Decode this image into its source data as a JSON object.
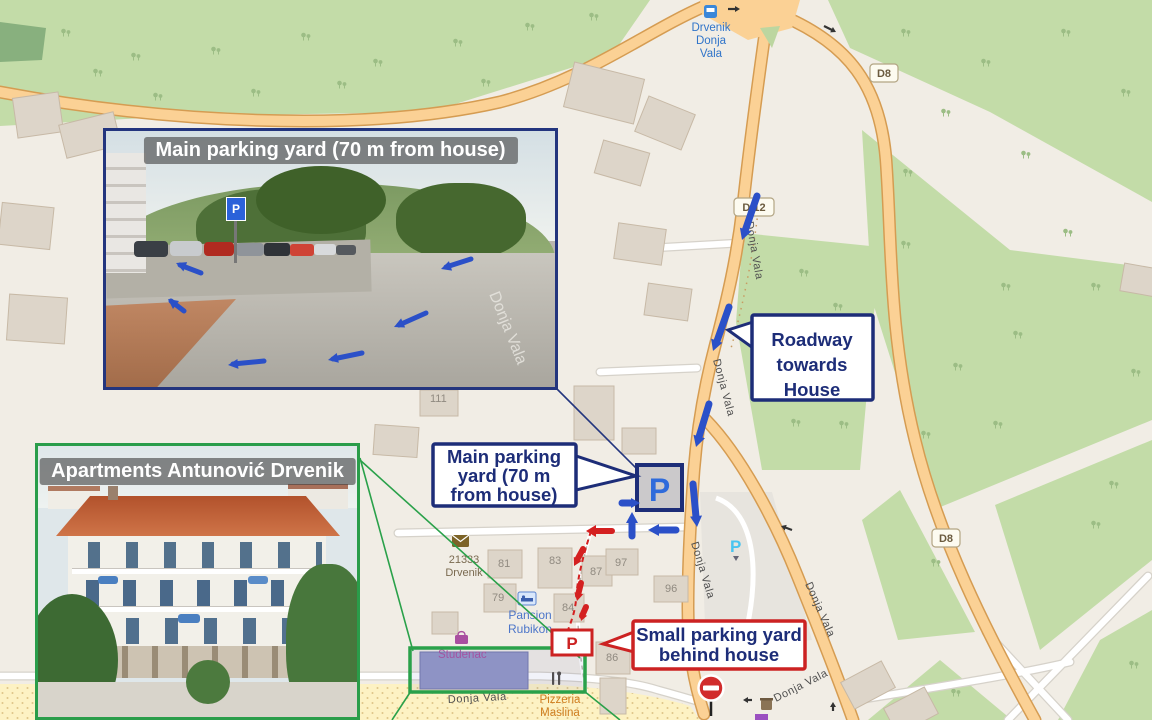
{
  "map": {
    "street_label": "Donja Vala",
    "badges": {
      "top_right": "D8",
      "d12": "D 12",
      "right": "D8"
    },
    "bus_stop": {
      "line1": "Drvenik",
      "line2": "Donja",
      "line3": "Vala"
    },
    "post_office": {
      "line1": "21333",
      "line2": "Drvenik"
    },
    "pansion": {
      "line1": "Pansion",
      "line2": "Rubikon"
    },
    "supermarket": "Studenac",
    "pizzeria": {
      "line1": "Pizzeria",
      "line2": "Maslina"
    },
    "parking_icon_letter": "P",
    "house_numbers": [
      "111",
      "81",
      "83",
      "87",
      "97",
      "96",
      "79",
      "84",
      "86"
    ]
  },
  "insets": {
    "parking_photo": {
      "title": "Main parking yard (70 m from house)",
      "sign_letter": "P"
    },
    "apartment_photo": {
      "title": "Apartments Antunović Drvenik"
    }
  },
  "callouts": {
    "roadway": {
      "line1": "Roadway",
      "line2": "towards",
      "line3": "House"
    },
    "main_parking": {
      "line1": "Main parking",
      "line2": "yard (70 m",
      "line3": "from house)"
    },
    "small_parking": {
      "line1": "Small parking yard",
      "line2": "behind house"
    }
  },
  "markers": {
    "main_parking_letter": "P",
    "small_parking_letter": "P"
  },
  "colors": {
    "annotation_blue": "#1d2d78",
    "arrow_blue": "#2b50c8",
    "annotation_red": "#d42020",
    "annotation_green": "#2aa14a",
    "road_fill": "#fbd195",
    "scrub_green": "#c3dca8"
  }
}
